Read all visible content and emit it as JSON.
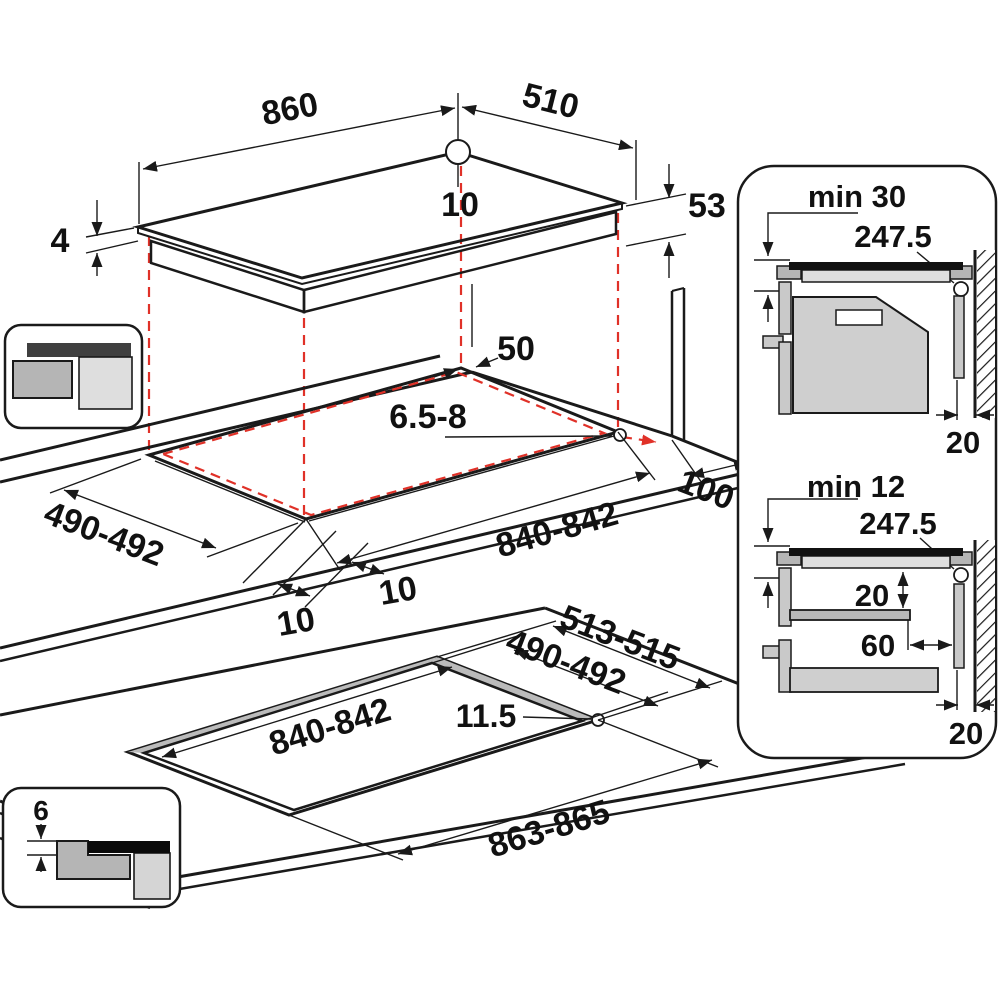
{
  "diagram": {
    "title": "hob-installation-dimensions",
    "colors": {
      "line": "#1a1a1a",
      "projection_red": "#e03128",
      "gray_light": "#dedede",
      "gray_mid": "#b5b5b5",
      "gray_dark": "#3f3f3f"
    },
    "hob_view": {
      "width": "860",
      "depth": "510",
      "cable_offset": "10",
      "body_height": "53",
      "glass_thickness": "4"
    },
    "cutout_view": {
      "rear_clearance": "50",
      "corner_radius": "6.5-8",
      "depth_range": "490-492",
      "overhang_left": "10",
      "overhang_right": "10",
      "width_range": "840-842",
      "side_clearance": "100"
    },
    "flush_view": {
      "outer_depth": "513-515",
      "inner_depth": "490-492",
      "inner_width": "840-842",
      "step_radius": "11.5",
      "outer_width": "863-865"
    },
    "flush_icon": {
      "recess_depth": "6"
    },
    "side_view_oven": {
      "min_clearance": "min 30",
      "cable_position": "247.5",
      "wall_gap": "20"
    },
    "side_view_drawer": {
      "min_clearance": "min 12",
      "cable_position": "247.5",
      "shelf_gap": "20",
      "shelf_to_wall": "60",
      "wall_gap": "20"
    }
  }
}
